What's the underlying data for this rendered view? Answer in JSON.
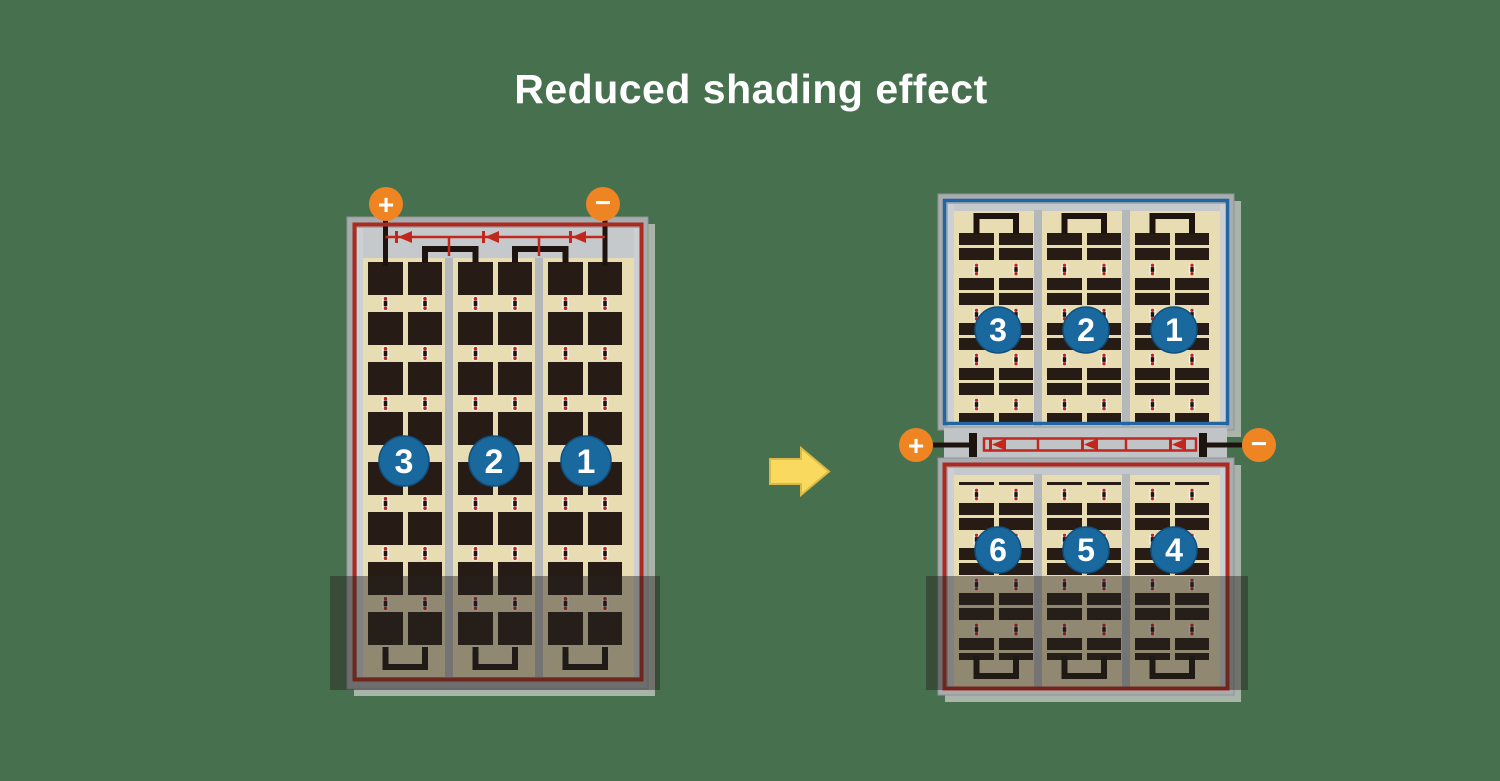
{
  "title": "Reduced shading effect",
  "left_panel": {
    "description": "single module, shaded at bottom",
    "terminals": {
      "positive": "+",
      "negative": "−"
    },
    "section_labels": [
      "3",
      "2",
      "1"
    ]
  },
  "right_panel": {
    "description": "split module, shaded at bottom",
    "terminals": {
      "positive": "+",
      "negative": "−"
    },
    "top_section_labels": [
      "3",
      "2",
      "1"
    ],
    "bottom_section_labels": [
      "6",
      "5",
      "4"
    ]
  },
  "icons": {
    "arrow": "right-block-arrow",
    "diode": "bypass-diode-left",
    "plus": "+",
    "minus": "−"
  },
  "colors": {
    "background": "#47704e",
    "title_text": "#ffffff",
    "panel_frame": "#a8acaf",
    "panel_border_red": "#ac2a20",
    "panel_border_blue": "#2166a2",
    "cell_background": "#e8ddb2",
    "cell_dark": "#261c15",
    "terminal_orange": "#ee8522",
    "badge_blue": "#19699e",
    "wire_red": "#c1271c",
    "arrow_yellow": "#f9da5e",
    "shade_overlay": "rgba(38,34,32,0.45)"
  }
}
